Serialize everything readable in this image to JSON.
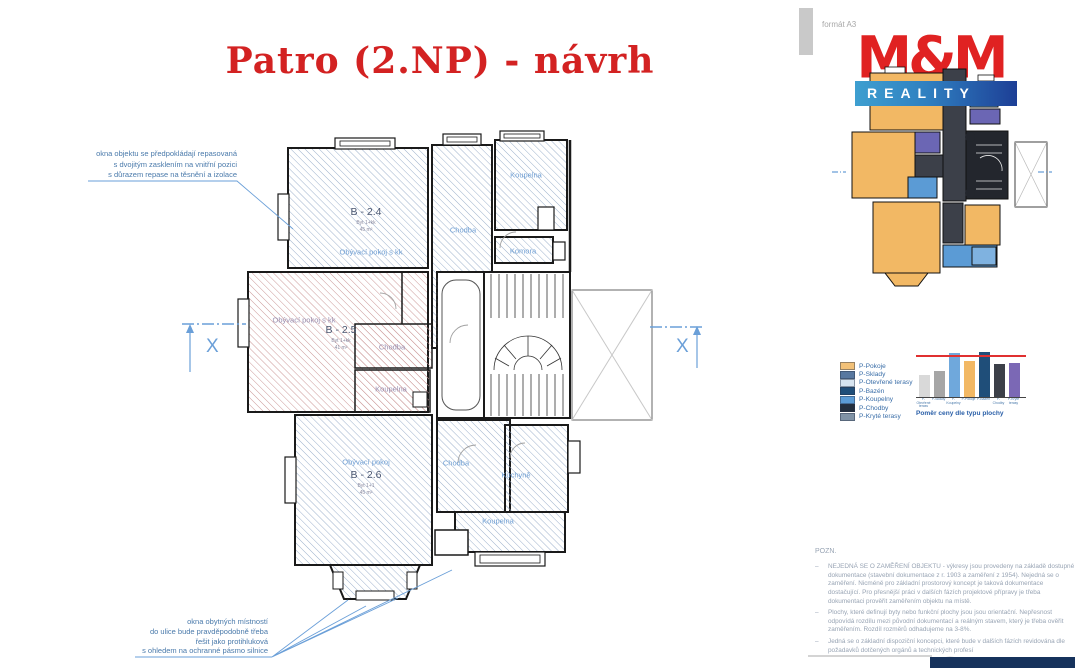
{
  "title": "Patro (2.NP) - návrh",
  "format_label": "formát A3",
  "logo": {
    "name": "M&M",
    "subtitle": "REALITY"
  },
  "annotations": {
    "top_left": "okna objektu se předpokládají repasovaná\ns dvojitým zasklením na vnitřní pozici\ns důrazem repase na těsnění a izolace",
    "bottom": "okna obytných místností\ndo ulice bude pravděpodobně třeba\nřešit jako protihluková\ns ohledem na ochranné pásmo silnice"
  },
  "plan": {
    "section_marker": "X",
    "rooms": {
      "b24": {
        "code": "B - 2.4",
        "unit": "Byt 1+kk",
        "area": "45 m²",
        "label": "Obývací pokoj s kk"
      },
      "b25": {
        "code": "B - 2.5",
        "unit": "Byt 1+kk",
        "area": "41 m²",
        "label": "Obývací pokoj s kk"
      },
      "b26": {
        "code": "B - 2.6",
        "unit": "Byt 1+1",
        "area": "45 m²",
        "label": "Obývací pokoj"
      },
      "chodba_top": "Chodba",
      "koupelna_top": "Koupelna",
      "komora": "Komora",
      "chodba_mid": "Chodba",
      "koupelna_mid": "Koupelna",
      "chodba_bottom": "Chodba",
      "kuchyne": "Kuchyně",
      "koupelna_bottom": "Koupelna"
    }
  },
  "legend": {
    "items": [
      {
        "label": "P-Pokoje",
        "color": "#f2c178"
      },
      {
        "label": "P-Sklady",
        "color": "#5878a0"
      },
      {
        "label": "P-Otevřené terasy",
        "color": "#d6e4f0"
      },
      {
        "label": "P-Bazén",
        "color": "#1f4e79"
      },
      {
        "label": "P-Koupelny",
        "color": "#5b9bd5"
      },
      {
        "label": "P-Chodby",
        "color": "#232f3e"
      },
      {
        "label": "P-Kryté terasy",
        "color": "#8093a6"
      }
    ]
  },
  "chart_data": {
    "type": "bar",
    "title": "Poměr ceny dle typu plochy",
    "categories": [
      "P-Otevřené terasy",
      "P-Sklady",
      "P-Koupelny",
      "P-Pokoje",
      "P-Bazén",
      "P-Chodby",
      "P-Kryté terasy"
    ],
    "values": [
      48,
      57,
      95,
      78,
      97,
      72,
      75
    ],
    "bar_colors": [
      "#d9d9d9",
      "#a6a6a6",
      "#6fa8dc",
      "#f2b864",
      "#1f4e79",
      "#3c4049",
      "#7b68b5"
    ],
    "reference_line": {
      "value": 88,
      "color": "#e03030"
    },
    "ylim": [
      0,
      100
    ],
    "legend_position": "left",
    "grid": false
  },
  "notes": {
    "heading": "POZN.",
    "bullet": "–",
    "items": [
      "NEJEDNÁ SE O ZAMĚŘENÍ OBJEKTU - výkresy jsou provedeny na základě dostupné dokumentace (stavební dokumentace z r. 1903 a zaměření z 1954). Nejedná se o zaměření. Nicméně pro základní prostorový koncept je taková dokumentace dostačující. Pro přesnější práci v dalších fázích projektové přípravy je třeba dokumentaci prověřit zaměřením objektu na místě.",
      "Plochy, které definují byty nebo funkční plochy jsou jsou orientační. Nepřesnost odpovídá rozdílu mezi původní dokumentací a reálným stavem, který je třeba ověřit zaměřením. Rozdíl rozměrů odhadujeme na 3-8%.",
      "Jedná se o základní dispoziční koncepci, které bude v dalších fázích revidována dle požadavků dotčených orgánů a technických profesí"
    ]
  }
}
